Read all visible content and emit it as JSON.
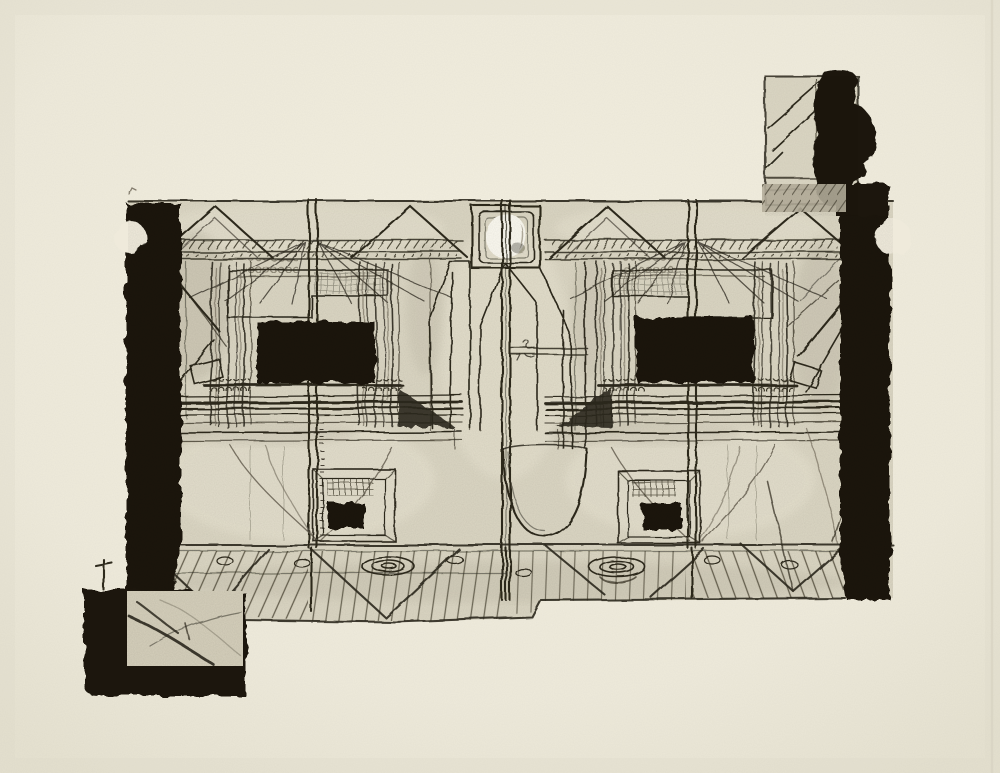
{
  "artwork": {
    "alt": "Black ink etching on cream paper: a mirror-symmetrical room interior with two curtained windows, ceiling gables, a central basin, plank flooring, and collaged black blocks at the upper-right and lower-left corners",
    "medium_label": "intaglio print / etching with collaged elements",
    "plate_region": "central rectangular plate with heavy black side borders, each bitten by a semicircular notch",
    "motifs": {
      "ceiling": "four gable triangles over hatched joist bands",
      "roundel": "square housing with a bright white circular void at top center",
      "left_room": "curtained bay with solid black window rectangle, curtain rod with rings, hearth with small black opening",
      "right_room": "mirrored curtained bay with solid black window rectangle, curtain rod with rings, hearth with small black opening",
      "center_bay": "tall tapered pillars flanking a deep U-shaped basin",
      "floor": "perspective plank floor with spiral plate marks, oval knots and X braces",
      "top_right_block": "collaged square panel with diagonal hatching beside a dense black blob",
      "bottom_left_block": "black slab framing a gray panel crossed by branch-like lines"
    }
  },
  "palette": {
    "paper": "#efeadb",
    "paper_edge": "#e7e2d0",
    "plate": "#dcd7c4",
    "plate_light": "#eae5d3",
    "ink": "#1b1811",
    "line": "#2e2a1f",
    "line_soft": "#6a6354",
    "shade": "#a29b89",
    "highlight": "#fbf9f0",
    "gray_strip": "#b5ae9b"
  }
}
